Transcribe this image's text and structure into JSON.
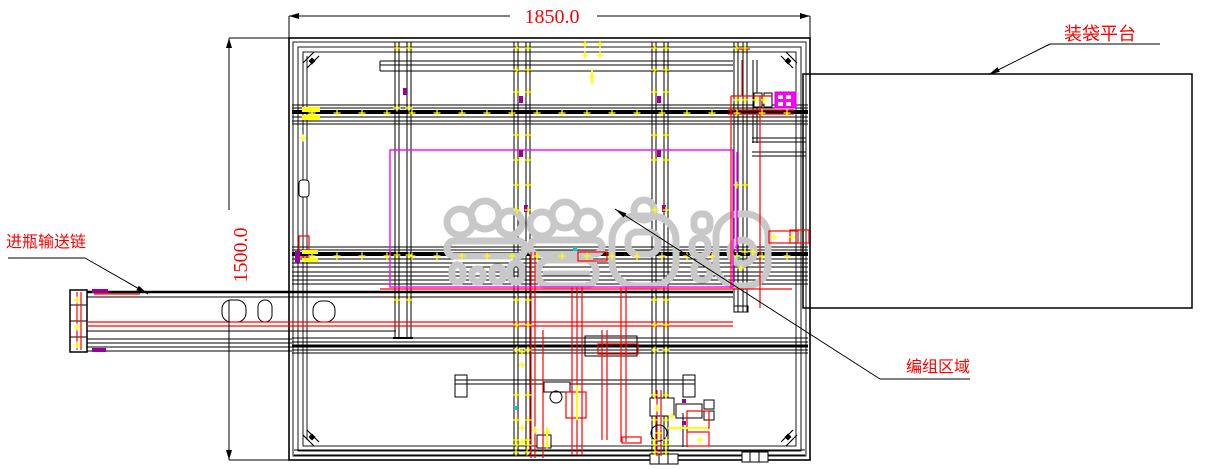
{
  "drawing": {
    "dimensions": {
      "width_label": "1850.0",
      "height_label": "1500.0"
    },
    "labels": {
      "platform": "装袋平台",
      "infeed": "进瓶输送链",
      "grouping": "编组区域"
    },
    "watermark": {
      "description": "faint gray outlined bubble-style watermark, 4 characters, illegible"
    },
    "colors": {
      "line": "#000000",
      "annotation_red": "#ff0000",
      "highlight_magenta": "#ff00ff",
      "marker_yellow": "#ffff00",
      "accent_purple": "#990099",
      "watermark_gray": "#c8c8c8",
      "background": "#ffffff"
    }
  }
}
